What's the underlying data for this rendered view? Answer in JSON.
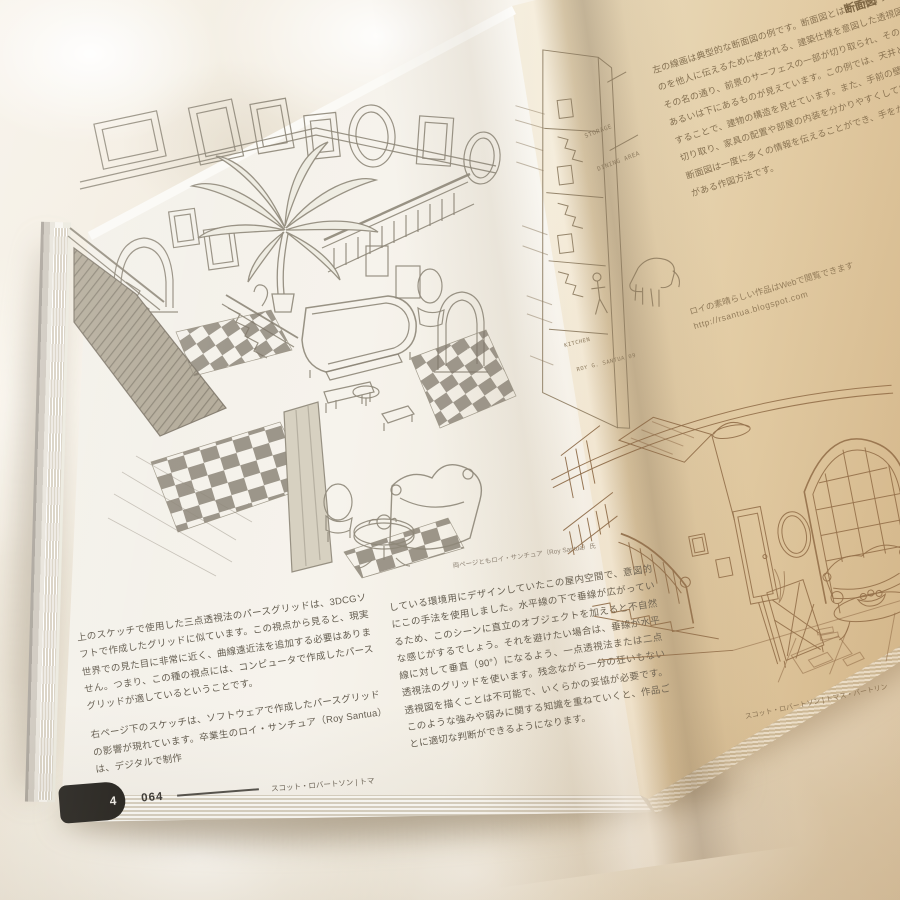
{
  "colors": {
    "blanket": "#f2ecdf",
    "left_page": "#f3f0e9",
    "right_page": "#e9dcc0",
    "pencil_ink": "#8e8779",
    "sepia_ink": "#8a6847",
    "chapter_tab_bg": "#262420"
  },
  "left_page": {
    "sketch_caption": "両ページともロイ・サンチュア（Roy Santua）氏",
    "body_col1_p1": "上のスケッチで使用した三点透視法のパースグリッドは、3DCGソフトで作成したグリッドに似ています。この視点から見ると、現実世界での見た目に非常に近く、曲線遠近法を追加する必要はありません。つまり、この種の視点には、コンピュータで作成したパースグリッドが適しているということです。",
    "body_col1_p2": "右ページ下のスケッチは、ソフトウェアで作成したパースグリッドの影響が現れています。卒業生のロイ・サンチュア（Roy Santua）は、デジタルで制作",
    "body_col2_p1": "している環境用にデザインしていたこの屋内空間で、意図的にこの手法を使用しました。水平線の下で垂線が広がっているため、このシーンに直立のオブジェクトを加えると不自然な感じがするでしょう。それを避けたい場合は、垂線が水平線に対して垂直（90°）になるよう、一点透視法または二点透視法のグリッドを使います。残念ながら一分の狂いもない透視図を描くことは不可能で、いくらかの妥協が必要です。このような強みや弱みに関する知識を重ねていくと、作品ごとに適切な判断ができるようになります。",
    "footer": {
      "chapter_tab": "4",
      "page_number": "064",
      "credit": "スコット・ロバートソン | トマ"
    }
  },
  "right_page": {
    "header_fragment": "断面図",
    "top_paragraph_lines": [
      "左の線画は典型的な断面図の例です。断面図とは、デザインし",
      "のを他人に伝えるために使われる、建築仕様を意図した透視図",
      "その名の通り、前景のサーフェスの一部が切り取られ、その向",
      "あるいは下にあるものが見えています。この例では、天井と内",
      "することで、建物の構造を見せています。また、手前の壁を",
      "切り取り、家具の配置や部屋の内装を分かりやすくしています",
      "断面図は一度に多くの情報を伝えることができ、手をかける",
      "がある作図方法です。"
    ],
    "cutaway_labels": {
      "storage": "STORAGE",
      "dining": "DINING AREA",
      "kitchen": "KITCHEN",
      "signature": "ROY G. SANTUA 09"
    },
    "web_note": "ロイの素晴らしい作品はWebで閲覧できます",
    "web_url": "http://rsantua.blogspot.com",
    "bottom_caption": "スコット・ロバートソン | トマス・バートリン"
  }
}
